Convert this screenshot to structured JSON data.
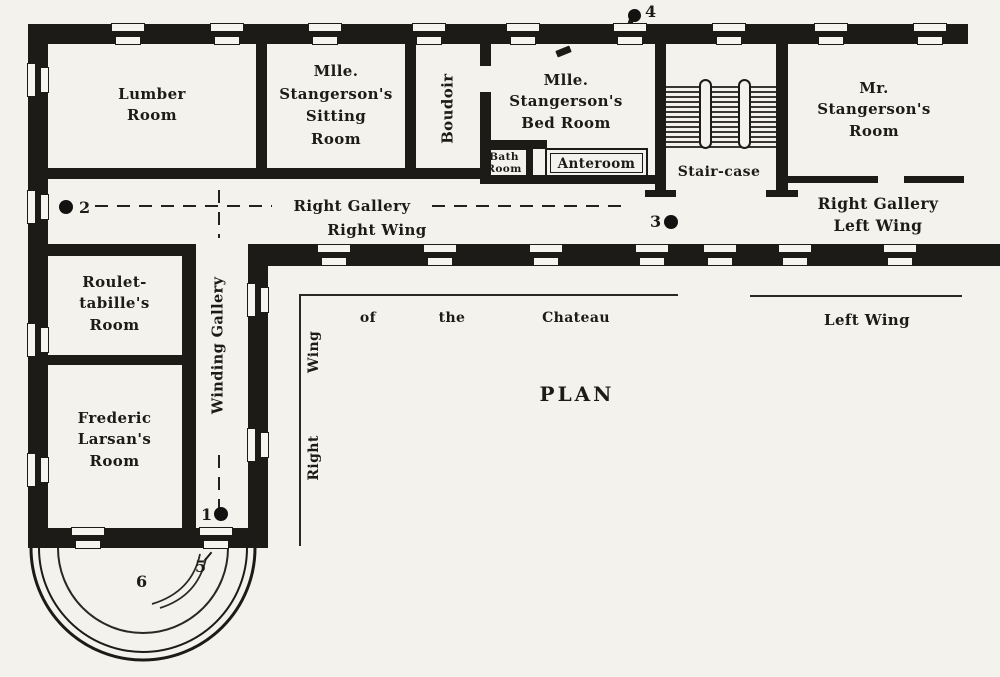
{
  "colors": {
    "paper": "#f4f2ec",
    "ink": "#1d1b18"
  },
  "rooms": {
    "lumber": "Lumber\nRoom",
    "sitting": "Mlle.\nStangerson's\nSitting\nRoom",
    "boudoir": "Boudoir",
    "bedroom": "Mlle.\nStangerson's\nBed Room",
    "bath": "Bath\nRoom",
    "anteroom": "Anteroom",
    "staircase": "Stair-case",
    "mr_stangerson": "Mr.\nStangerson's\nRoom",
    "roulettabille": "Roulet-\ntabille's\nRoom",
    "larsan": "Frederic\nLarsan's\nRoom"
  },
  "galleries": {
    "right_gallery": "Right Gallery",
    "right_wing": "Right Wing",
    "right_gallery_left_wing": "Right Gallery\nLeft Wing",
    "winding_gallery": "Winding Gallery"
  },
  "captions": {
    "plan": "PLAN",
    "of": "of",
    "the": "the",
    "chateau": "Chateau",
    "left_wing": "Left Wing",
    "right": "Right",
    "wing": "Wing"
  },
  "markers": {
    "m1": "1",
    "m2": "2",
    "m3": "3",
    "m4": "4",
    "m5": "5",
    "m6": "6"
  }
}
